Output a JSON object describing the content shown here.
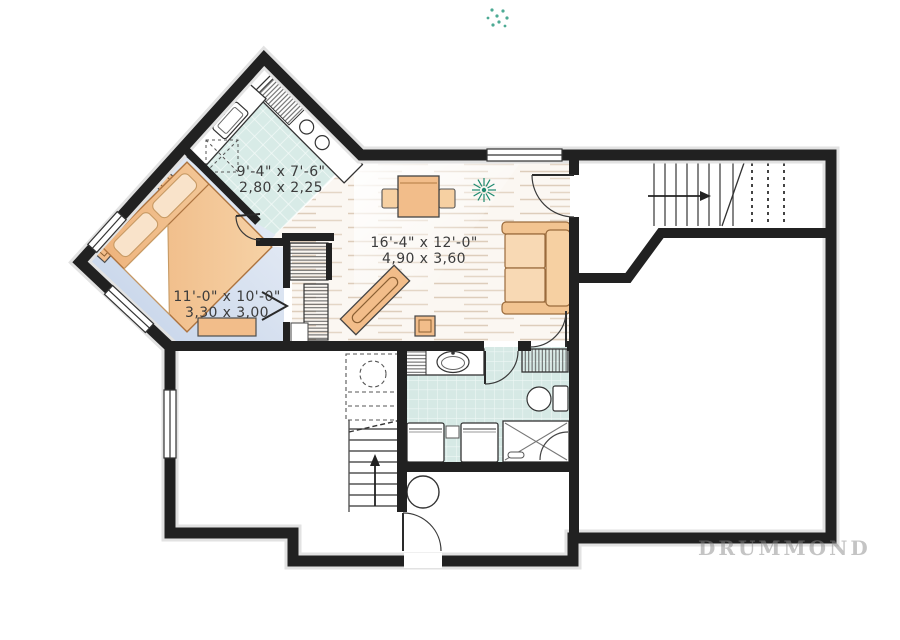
{
  "plan_title": "basement floor plan",
  "watermark": "DRUMMOND",
  "rooms": {
    "kitchen": {
      "imperial": "9'-4\" x 7'-6\"",
      "metric": "2,80 x 2,25"
    },
    "bedroom": {
      "imperial": "11'-0\" x 10'-0\"",
      "metric": "3,30 x 3,00"
    },
    "living": {
      "imperial": "16'-4\" x 12'-0\"",
      "metric": "4,90 x 3,60"
    }
  },
  "colors": {
    "wall": "#212121",
    "furniture_orange": "#f2bd8a",
    "tile_teal": "#d8ebe7",
    "bedroom_floor_blue": "#c5d4ea",
    "plant_green": "#1f8a70",
    "label_gray": "#3c3c3c"
  }
}
